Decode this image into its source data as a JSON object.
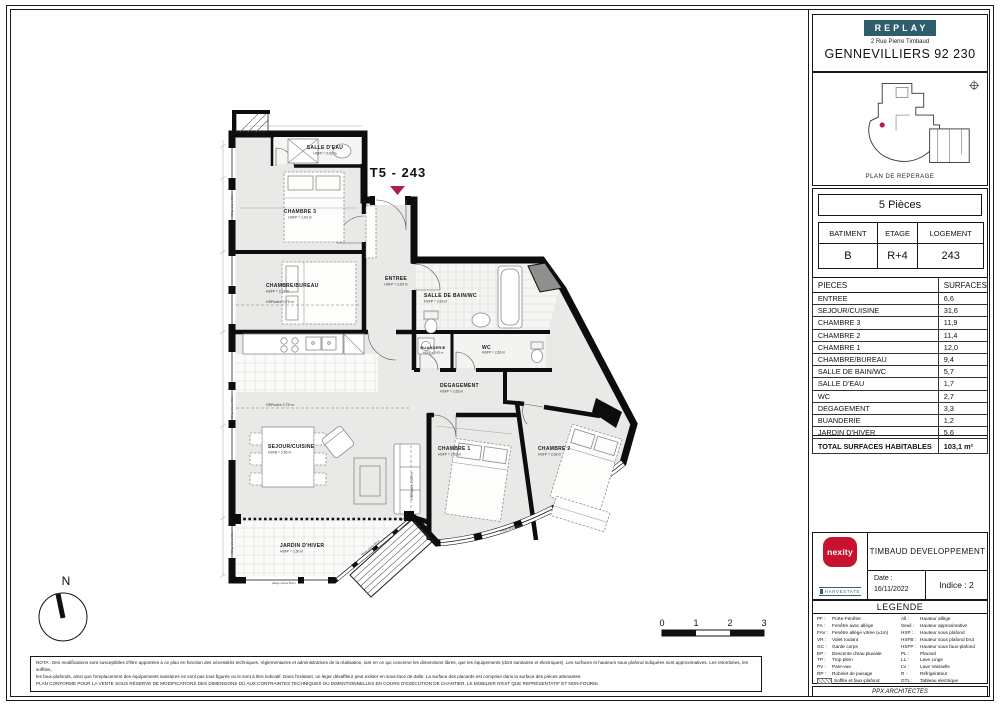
{
  "header": {
    "brand": "REPLAY",
    "address": "2 Rue Pierre Timbaud",
    "city": "GENNEVILLIERS 92 230",
    "reperage_caption": "PLAN DE REPERAGE"
  },
  "unit": {
    "title": "T5 - 243",
    "type_label": "5 Pièces"
  },
  "building_table": {
    "headers": [
      "BATIMENT",
      "ETAGE",
      "LOGEMENT"
    ],
    "values": [
      "B",
      "R+4",
      "243"
    ]
  },
  "surfaces_table": {
    "col_piece": "PIECES",
    "col_surface": "SURFACES",
    "rows": [
      {
        "piece": "ENTREE",
        "value": "6,6"
      },
      {
        "piece": "SEJOUR/CUISINE",
        "value": "31,6"
      },
      {
        "piece": "CHAMBRE 3",
        "value": "11,9"
      },
      {
        "piece": "CHAMBRE 2",
        "value": "11,4"
      },
      {
        "piece": "CHAMBRE 1",
        "value": "12,0"
      },
      {
        "piece": "CHAMBRE/BUREAU",
        "value": "9,4"
      },
      {
        "piece": "SALLE DE BAIN/WC",
        "value": "5,7"
      },
      {
        "piece": "SALLE D'EAU",
        "value": "1,7"
      },
      {
        "piece": "WC",
        "value": "2,7"
      },
      {
        "piece": "DEGAGEMENT",
        "value": "3,3"
      },
      {
        "piece": "BUANDERIE",
        "value": "1,2"
      },
      {
        "piece": "JARDIN D'HIVER",
        "value": "5,6"
      }
    ],
    "total_label": "TOTAL SURFACES HABITABLES",
    "total_value": "103,1 m²"
  },
  "title_block": {
    "developer": "TIMBAUD DEVELOPPEMENT",
    "date_label": "Date :",
    "date": "16/11/2022",
    "indice": "Indice :  2",
    "logo_main": "nexity",
    "logo_secondary": "HARVESTATE"
  },
  "legend": {
    "title": "LEGENDE",
    "left": [
      {
        "abbr": "PF :",
        "label": "Porte-Fenêtre"
      },
      {
        "abbr": "FA :",
        "label": "Fenêtre avec allège"
      },
      {
        "abbr": "FAV :",
        "label": "Fenêtre allège vitrée (±1m)"
      },
      {
        "abbr": "VR :",
        "label": "Volet roulant"
      },
      {
        "abbr": "GC :",
        "label": "Garde corps"
      },
      {
        "abbr": "EP :",
        "label": "Descente d'eau pluviale"
      },
      {
        "abbr": "TP :",
        "label": "Trop plein"
      },
      {
        "abbr": "PV :",
        "label": "Pare-vue"
      },
      {
        "abbr": "RP :",
        "label": "Robinet de puisage"
      },
      {
        "abbr": "",
        "label": "Soffite et faux-plafond"
      }
    ],
    "right": [
      {
        "abbr": "All :",
        "label": "Hauteur allège"
      },
      {
        "abbr": "Seuil :",
        "label": "Hauteur approximative"
      },
      {
        "abbr": "HSP :",
        "label": "Hauteur sous plafond"
      },
      {
        "abbr": "HSFB :",
        "label": "Hauteur sous plafond brut"
      },
      {
        "abbr": "HSFP :",
        "label": "Hauteur sous faux-plafond"
      },
      {
        "abbr": "PL :",
        "label": "Placard"
      },
      {
        "abbr": "LL :",
        "label": "Lave Linge"
      },
      {
        "abbr": "LV :",
        "label": "Lave Vaisselle"
      },
      {
        "abbr": "R :",
        "label": "Réfrigérateur"
      },
      {
        "abbr": "GTL :",
        "label": "Tableau electrique"
      }
    ],
    "architect": "PPX ARCHITECTES"
  },
  "nota": {
    "line1": "NOTA : Des modifications sont susceptibles d'être apportées à ce plan en fonction des nécessités techniques, réglementaires et administratives de la réalisation, tant en ce qui concerne les dimensions libres, que les équipements (dont sanitaires et électriques). Les surfaces et hauteurs sous plafond indiquées sont approximatives. Les retombées, les soffites,",
    "line2": "les faux-plafonds, ainsi que l'emplacement des équipements sanitaires ne sont pas tous figurés ou le sont à titre indicatif. Dans l'existant, un léger désaffleur peut exister en sous-face de dalle. La surface des placards est comprise dans la surface des pièces attenantes.",
    "line3": "PLAN CONFORME POUR LA VENTE SOUS RÉSERVE DE MODIFICATIONS DES DIMENSIONS DÛ AUX CONTRAINTES TECHNIQUES OU DIMENTIONNELLES EN COURS D'EXÉCUTION DE CHANTIER. LE MOBILIER N'EST QUE REPRÉSENTATIF ET NON-FOURNI."
  },
  "plan": {
    "rooms": [
      {
        "name": "ENTREE",
        "sub": "HSFP = 2,63 m"
      },
      {
        "name": "SEJOUR/CUISINE",
        "sub": "HSFB = 2,65 m"
      },
      {
        "name": "CHAMBRE 3",
        "sub": "HSFP = 2,63 m"
      },
      {
        "name": "CHAMBRE 2",
        "sub": "HSFP = 2,63 m"
      },
      {
        "name": "CHAMBRE 1",
        "sub": "HSFP = 2,63 m"
      },
      {
        "name": "CHAMBRE/BUREAU",
        "sub": "HSFP = 2,63 m"
      },
      {
        "name": "SALLE DE BAIN/WC",
        "sub": "HSFP = 2,63 m"
      },
      {
        "name": "SALLE D'EAU",
        "sub": "HSFP = 2,63 m"
      },
      {
        "name": "WC",
        "sub": "HSFP = 2,63 m"
      },
      {
        "name": "DEGAGEMENT",
        "sub": "HSFP = 2,63 m"
      },
      {
        "name": "BUANDERIE",
        "sub": "HSFP = 2,63 m"
      },
      {
        "name": "JARDIN D'HIVER",
        "sub": "HSFP = 2,50 m"
      }
    ],
    "annotations": {
      "beam1": "HSPoutre 2,75 m",
      "beam2": "HSPoutre 2,75 m",
      "beam3": "HSPoutre 2,65 m",
      "window_label": "Allège pleine 60cm"
    },
    "compass_n": "N",
    "scale_ticks": [
      "0",
      "1",
      "2",
      "3"
    ]
  },
  "colors": {
    "accent_crimson": "#b01e45",
    "brand_teal": "#305d6b",
    "nexity_red": "#c8132e",
    "wall_black": "#0d0d0d",
    "room_fill": "#e9e9e7"
  }
}
